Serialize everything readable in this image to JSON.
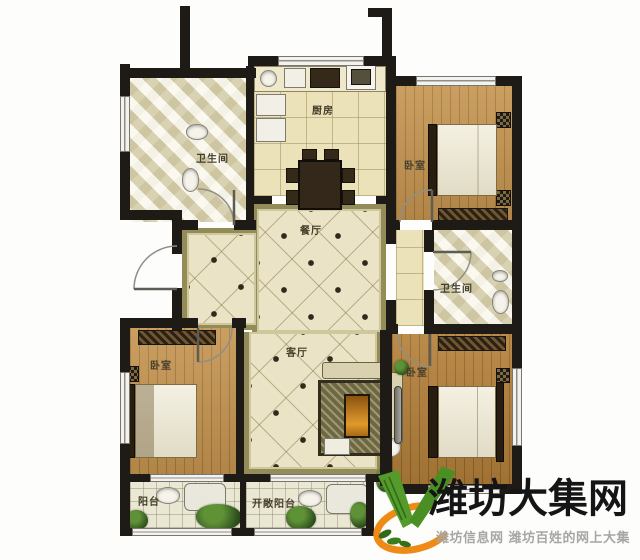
{
  "plan": {
    "type": "apartment-floor-plan",
    "rooms": {
      "bathroom_top": {
        "label": "卫生间"
      },
      "kitchen": {
        "label": "厨房"
      },
      "bedroom_top_right": {
        "label": "卧室"
      },
      "dining": {
        "label": "餐厅"
      },
      "living": {
        "label": "客厅"
      },
      "bathroom_right": {
        "label": "卫生间"
      },
      "bedroom_bottom_left": {
        "label": "卧室"
      },
      "bedroom_bottom_right": {
        "label": "卧室"
      },
      "balcony": {
        "label": "阳台"
      },
      "open_balcony": {
        "label": "开敞阳台"
      }
    }
  },
  "watermark": {
    "title": "潍坊大集网",
    "subtitle": "潍坊信息网 潍坊百姓的网上大集"
  },
  "colors": {
    "wall": "#1e1b16",
    "hall_tile": "#ebe3c5",
    "hall_band": "#938c58",
    "wood_floor": "#c4944f",
    "wood_floor_dark": "#b5813b",
    "bath_tile": "#ece6ca",
    "kitchen_floor": "#ece2b9",
    "balcony_floor": "#eae7d3",
    "plant_green": "#2c4e1c",
    "logo_green": "#559b2b",
    "logo_orange": "#ee8a15",
    "watermark_title": "#151515",
    "watermark_subtitle": "#a6a6a6"
  }
}
